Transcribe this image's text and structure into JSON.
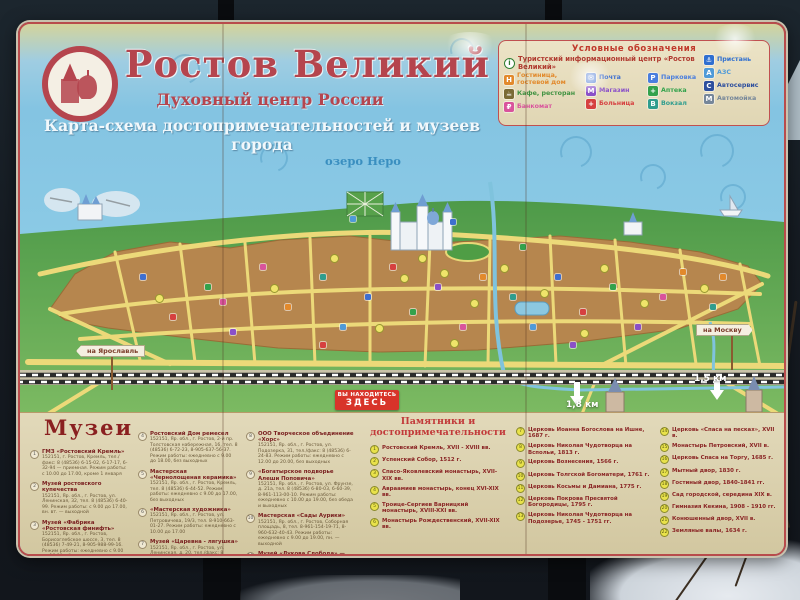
{
  "board": {
    "title": "Ростов Великий –",
    "subtitle": "Духовный центр России",
    "caption": "Карта-схема достопримечательностей и музеев города"
  },
  "legend": {
    "title": "Условные обозначения",
    "info": "Туристский информационный центр «Ростов Великий»",
    "info_glyph": "i",
    "columns": [
      [
        {
          "label": "Гостиница, гостевой дом",
          "color": "#e2892b",
          "glyph": "H"
        },
        {
          "label": "Кафе, ресторан",
          "color": "#7a6a35",
          "text_color": "#3f9140",
          "glyph": "☕"
        },
        {
          "label": "Банкомат",
          "color": "#d9539c",
          "glyph": "₽"
        }
      ],
      [
        {
          "label": "Почта",
          "color": "#3e6fd0",
          "glyph": "✉"
        },
        {
          "label": "Магазин",
          "color": "#8a50c8",
          "glyph": "М"
        },
        {
          "label": "Больница",
          "color": "#d64040",
          "glyph": "+"
        }
      ],
      [
        {
          "label": "Парковка",
          "color": "#4a7ede",
          "glyph": "P"
        },
        {
          "label": "Аптека",
          "color": "#33a24c",
          "glyph": "+"
        },
        {
          "label": "Вокзал",
          "color": "#2f9d8e",
          "glyph": "В"
        }
      ],
      [
        {
          "label": "Пристань",
          "color": "#2f6fd0",
          "glyph": "⚓"
        },
        {
          "label": "АЗС",
          "color": "#4f9ad8",
          "glyph": "А"
        },
        {
          "label": "Автосервис",
          "color": "#2d4f9e",
          "glyph": "С"
        },
        {
          "label": "Автомойка",
          "color": "#76879a",
          "glyph": "М"
        }
      ]
    ]
  },
  "map": {
    "lake_label": "озеро Неро",
    "you_are_here_line1": "ВЫ НАХОДИТЕСЬ",
    "you_are_here_line2": "ЗДЕСЬ",
    "sign_left": "на Ярославль",
    "sign_right": "на Москву",
    "dist_left": "1,8 км",
    "dist_right": "1,5 км"
  },
  "museums": {
    "header": "Музеи",
    "items": [
      {
        "num": "1",
        "name": "ГМЗ «Ростовский Кремль»",
        "details": "152151, г. Ростов, Кремль, тел./факс: 8 (48536) 6-15-02, 6-17-17, 6-32-94 — приемная. Режим работы: с 10.00 до 17.00, кроме 1 января"
      },
      {
        "num": "2",
        "name": "Музей ростовского купечества",
        "details": "152151, Яр. обл., г. Ростов, ул. Ленинская, 32, тел. 8 (48536) 6-40-99. Режим работы: с 9.00 до 17.00, вн. вт. — выходной"
      },
      {
        "num": "3",
        "name": "Музей «Фабрика «Ростовская финифть»",
        "details": "152151, Яр. обл., г. Ростов, Борисоглебское шоссе, 3, тел. 8 (48536) 7-49-21, 8-905-988-99-16. Режим работы: ежедневно с 9.00 до 16.00, сб., вскр. — по предварительной записи"
      },
      {
        "num": "4",
        "name": "Ростовский Дом ремесел",
        "details": "152151, Яр. обл., г. Ростов, 2-й пр. Толстовская набережная, 16, тел. 8 (48536) 6-72-23, 8-905-637-56-37. Режим работы: ежедневно с 9.00 до 18.00, без выходных"
      },
      {
        "num": "5",
        "name": "Мастерская «Чернолощеная керамика»",
        "details": "152151, Яр. обл., г. Ростов, Кремль, тел. 8 (48536) 6-44-52. Режим работы: ежедневно с 9.00 до 17.00, без выходных"
      },
      {
        "num": "6",
        "name": "«Мастерская художника»",
        "details": "152151, Яр. обл., г. Ростов, ул. Петровичева, 19/3, тел. 8-910-663-01-27. Режим работы: ежедневно с 10.00 до 17.00"
      },
      {
        "num": "7",
        "name": "Музей «Царевна - лягушка»",
        "details": "152151, Яр. обл., г. Ростов, ул. Ленинская, д. 20, тел./факс: 8 (48536) 7-54-31, 7-50-60. Режим работы: ежедневно с 10.00 до 18.00"
      },
      {
        "num": "8",
        "name": "ООО Творческое объединение «Хорс»",
        "details": "152151, Яр. обл., г. Ростов, ул. Подозерка, 31, тел./факс: 8 (48536) 6-24-83. Режим работы: ежедневно с 12.00 до 20.00, без выходных"
      },
      {
        "num": "9",
        "name": "«Богатырское подворье Алеши Поповича»",
        "details": "152151, Яр. обл., г. Ростов, ул. Фрунзе, д. 21а, тел. 8 (48536) 6-80-03, 6-60-39, 8-961-113-00-10. Режим работы: ежедневно с 10.00 до 19.00, без обеда и выходных"
      },
      {
        "num": "10",
        "name": "Мастерская «Сады Аурики»",
        "details": "152151, Яр. обл., г. Ростов, Соборная площадь, 8, тел. 8-961-154-19-71, 8-960-632-40-43. Режим работы: ежедневно с 9.00 до 19.00, пн. — выходной"
      },
      {
        "num": "11",
        "name": "Музей «Лукова Слобода» — народная академия ухи «Щучье подворье»",
        "details": "152151, Яр. обл., г. Ростов, ул. Достоевского, 39, тел. 8-910-973-43-66, 8 (48536) 32-86-00. Режим работы: ежедневно с 10.00 до 17.00 без выходных"
      }
    ]
  },
  "monuments": {
    "header_line1": "Памятники и",
    "header_line2": "достопримечательности",
    "items": [
      {
        "num": "1",
        "text": "Ростовский Кремль, XVII - XVIII вв."
      },
      {
        "num": "2",
        "text": "Успенский Собор, 1512 г."
      },
      {
        "num": "3",
        "text": "Спасо-Яковлевский монастырь, XVII-XIX вв."
      },
      {
        "num": "4",
        "text": "Авраамиев монастырь, конец XVI-XIX вв."
      },
      {
        "num": "5",
        "text": "Троице-Сергиев Варницкий монастырь, XVIII-XXI вв."
      },
      {
        "num": "6",
        "text": "Монастырь Рождественский, XVII-XIX вв."
      },
      {
        "num": "7",
        "text": "Церковь Иоанна Богослова на Ишне, 1687 г."
      },
      {
        "num": "8",
        "text": "Церковь Николая Чудотворца на Вспольи, 1813 г."
      },
      {
        "num": "9",
        "text": "Церковь Вознесения, 1566 г."
      },
      {
        "num": "10",
        "text": "Церковь Толгской Богоматери, 1761 г."
      },
      {
        "num": "11",
        "text": "Церковь Косьмы и Дамиана, 1775 г."
      },
      {
        "num": "12",
        "text": "Церковь Покрова Пресвятой Богородицы, 1795 г."
      },
      {
        "num": "13",
        "text": "Церковь Николая Чудотворца на Подозерье, 1745 - 1751 гг."
      },
      {
        "num": "14",
        "text": "Церковь «Спаса на песках», XVII в."
      },
      {
        "num": "15",
        "text": "Монастырь Петровский, XVII в."
      },
      {
        "num": "16",
        "text": "Церковь Спаса на Торгу, 1685 г."
      },
      {
        "num": "17",
        "text": "Мытный двор, 1830 г."
      },
      {
        "num": "18",
        "text": "Гостиный двор, 1840-1841 гг."
      },
      {
        "num": "19",
        "text": "Сад городской, середина XIX в."
      },
      {
        "num": "20",
        "text": "Гимназия Кекина, 1908 - 1910 гг."
      },
      {
        "num": "21",
        "text": "Конюшенный двор, XVII в."
      },
      {
        "num": "22",
        "text": "Земляные валы, 1634 г."
      }
    ]
  }
}
